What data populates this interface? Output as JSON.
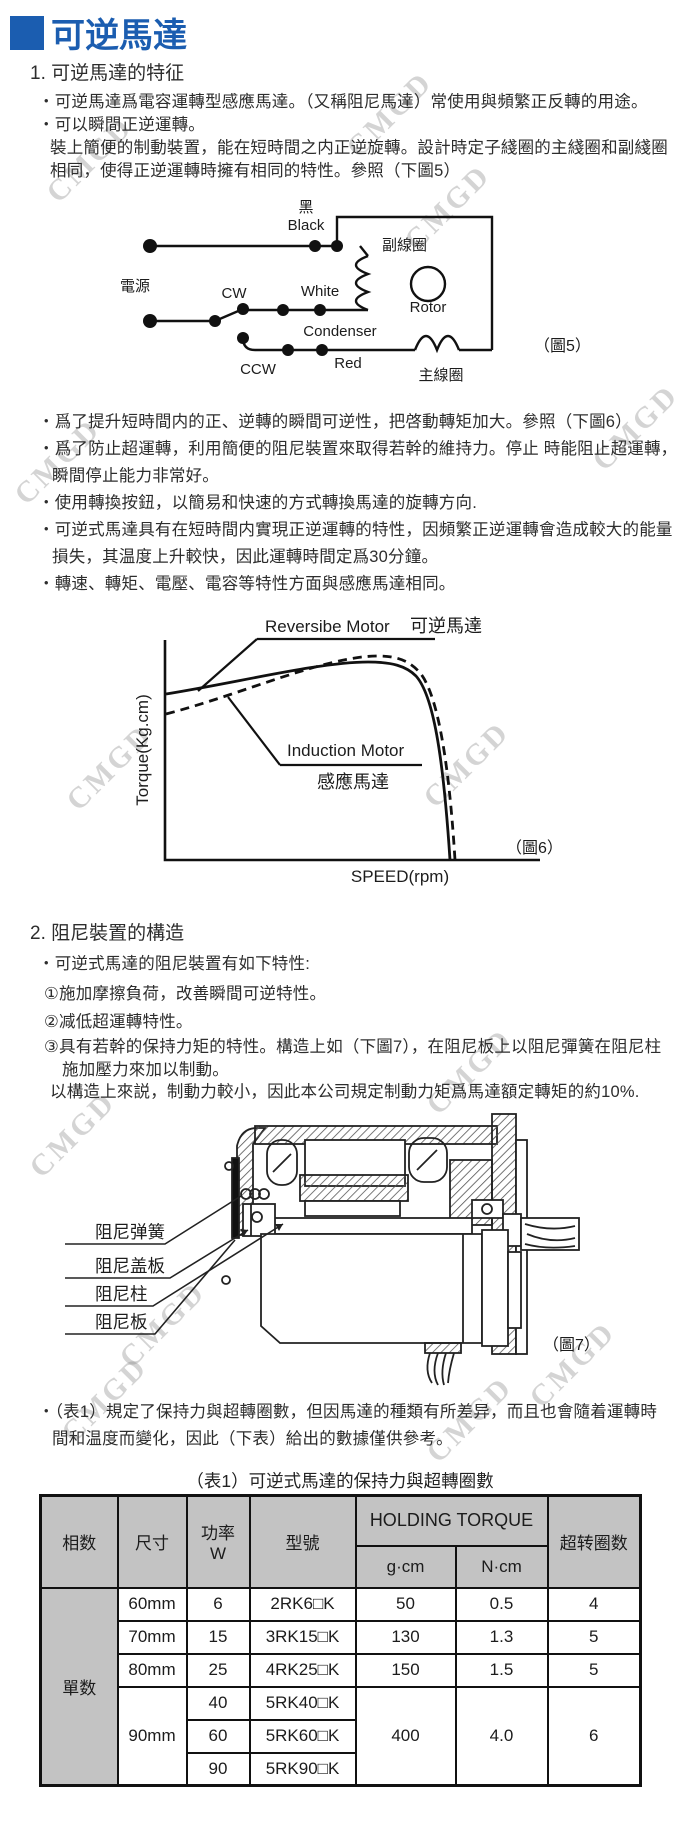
{
  "page": {
    "title": "可逆馬達",
    "accent_color": "#1b5db0",
    "watermark": "CMGD"
  },
  "section1": {
    "heading": "1. 可逆馬達的特征",
    "lines": [
      "・可逆馬達爲電容運轉型感應馬達。（又稱阻尼馬達）常使用與頻繁正反轉的用途。",
      "・可以瞬間正逆運轉。",
      "裝上簡便的制動裝置，能在短時間之内正逆旋轉。設計時定子綫圈的主綫圈和副綫圈",
      "相同，使得正逆運轉時擁有相同的特性。參照（下圖5）"
    ]
  },
  "figure5": {
    "caption": "（圖5）",
    "labels": {
      "power": "電源",
      "black_cn": "黑",
      "black": "Black",
      "cw": "CW",
      "ccw": "CCW",
      "white": "White",
      "red": "Red",
      "condenser": "Condenser",
      "rotor": "Rotor",
      "aux_coil": "副線圈",
      "main_coil": "主線圈"
    }
  },
  "bullets_after_fig5": [
    "・爲了提升短時間内的正、逆轉的瞬間可逆性，把啓動轉矩加大。參照（下圖6）",
    "・爲了防止超運轉，利用簡便的阻尼裝置來取得若幹的維持力。停止 時能阻止超運轉，",
    "瞬間停止能力非常好。",
    "・使用轉換按鈕，以簡易和快速的方式轉換馬達的旋轉方向.",
    "・可逆式馬達具有在短時間内實現正逆運轉的特性，因頻繁正逆運轉會造成較大的能量",
    "損失，其温度上升較快，因此運轉時間定爲30分鐘。",
    "・轉速、轉矩、電壓、電容等特性方面與感應馬達相同。"
  ],
  "figure6": {
    "caption": "（圖6）",
    "ylabel": "Torque(Kg.cm)",
    "xlabel": "SPEED(rpm)",
    "series1": "Reversibe Motor",
    "series1_cn": "可逆馬達",
    "series2": "Induction Motor",
    "series2_cn": "感應馬達"
  },
  "chart_data": {
    "type": "line",
    "title": "Torque vs Speed characteristic (圖6)",
    "xlabel": "SPEED(rpm)",
    "ylabel": "Torque(Kg.cm)",
    "axis_ticks_labeled": false,
    "legend_position": "inline-annotations",
    "series": [
      {
        "name": "Reversibe Motor 可逆馬達",
        "style": "solid",
        "points_norm_xy": [
          [
            0.0,
            0.62
          ],
          [
            0.25,
            0.7
          ],
          [
            0.55,
            0.76
          ],
          [
            0.68,
            0.76
          ],
          [
            0.78,
            0.68
          ],
          [
            0.86,
            0.4
          ],
          [
            0.9,
            0.0
          ]
        ]
      },
      {
        "name": "Induction Motor 感應馬達",
        "style": "dashed",
        "points_norm_xy": [
          [
            0.0,
            0.55
          ],
          [
            0.25,
            0.66
          ],
          [
            0.58,
            0.78
          ],
          [
            0.71,
            0.78
          ],
          [
            0.81,
            0.66
          ],
          [
            0.88,
            0.35
          ],
          [
            0.92,
            0.0
          ]
        ]
      }
    ]
  },
  "section2": {
    "heading": "2. 阻尼裝置的構造",
    "lines": [
      "・可逆式馬達的阻尼裝置有如下特性:",
      "①施加摩擦負荷，改善瞬間可逆特性。",
      "②减低超運轉特性。",
      "③具有若幹的保持力矩的特性。構造上如（下圖7），在阻尼板上以阻尼彈簧在阻尼柱",
      "施加壓力來加以制動。",
      "以構造上來説，制動力較小，因此本公司規定制動力矩爲馬達額定轉矩的約10%."
    ]
  },
  "figure7": {
    "caption": "（圖7）",
    "labels": [
      "阻尼弹簧",
      "阻尼盖板",
      "阻尼柱",
      "阻尼板"
    ]
  },
  "table_note": [
    "・（表1）規定了保持力與超轉圈數，但因馬達的種類有所差异，而且也會隨着運轉時",
    "間和温度而變化，因此（下表）給出的數據僅供參考。"
  ],
  "table1": {
    "title": "（表1）可逆式馬達的保持力與超轉圈數",
    "headers": {
      "phase": "相数",
      "size": "尺寸",
      "power": "功率",
      "power_unit": "W",
      "model": "型號",
      "holding": "HOLDING TORQUE",
      "gcm": "g·cm",
      "ncm": "N·cm",
      "overrun": "超转圈数"
    },
    "phase_value": "單数",
    "rows": [
      {
        "size": "60mm",
        "power": "6",
        "model": "2RK6□K",
        "gcm": "50",
        "ncm": "0.5",
        "overrun": "4"
      },
      {
        "size": "70mm",
        "power": "15",
        "model": "3RK15□K",
        "gcm": "130",
        "ncm": "1.3",
        "overrun": "5"
      },
      {
        "size": "80mm",
        "power": "25",
        "model": "4RK25□K",
        "gcm": "150",
        "ncm": "1.5",
        "overrun": "5"
      },
      {
        "size": "90mm",
        "power": "40",
        "model": "5RK40□K",
        "gcm": "400",
        "ncm": "4.0",
        "overrun": "6"
      },
      {
        "power": "60",
        "model": "5RK60□K"
      },
      {
        "power": "90",
        "model": "5RK90□K"
      }
    ]
  }
}
